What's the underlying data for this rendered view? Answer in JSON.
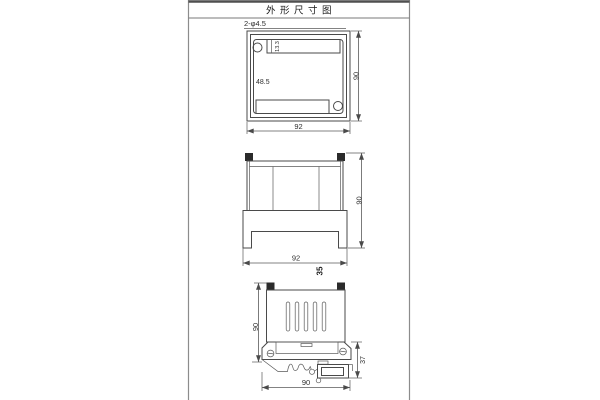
{
  "page": {
    "title": "外形尺寸图",
    "bg_color": "#ffffff",
    "line_color": "#4a4a4a",
    "frame_color": "#8c8c8c",
    "terminal_fill": "#2b2b2b"
  },
  "top_view": {
    "hole_callout": "2-φ4.5",
    "width": "92",
    "height": "90",
    "inner_height": "48.5",
    "notch_depth": "13.3"
  },
  "front_view": {
    "width": "92",
    "height": "90",
    "depth": "35"
  },
  "side_view": {
    "height": "90",
    "clip_height": "37",
    "rail_width": "90"
  }
}
